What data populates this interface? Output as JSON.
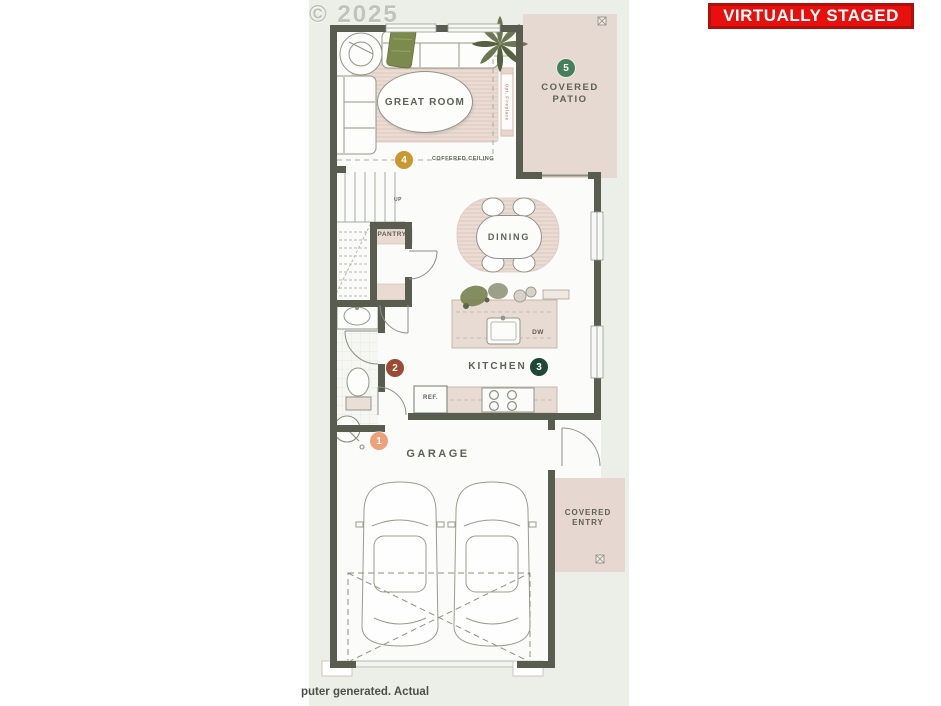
{
  "banner": {
    "label": "VIRTUALLY STAGED",
    "bg": "#e8100c",
    "border": "#b00f0b",
    "text": "#ffffff"
  },
  "watermark": "© 2025",
  "footer_fragment": "puter generated. Actual",
  "plan": {
    "colors": {
      "wall": "#585d50",
      "panel_bg": "#ecefe8",
      "floor": "#fbfcf9",
      "patio_beige": "#e6d9d1",
      "rug_beige": "#eadbd3",
      "label_text": "#5d6156"
    },
    "labels": {
      "great_room": "GREAT ROOM",
      "covered_patio": "COVERED PATIO",
      "dining": "DINING",
      "kitchen": "KITCHEN",
      "pantry": "PANTRY",
      "garage": "GARAGE",
      "covered_entry": "COVERED ENTRY",
      "ref": "REF.",
      "dw": "DW",
      "up": "UP",
      "coffered_ceiling": "COFFERED CEILING",
      "opt_fireplace": "Opt. Fireplace"
    },
    "markers": [
      {
        "num": "1",
        "room": "garage",
        "color": "#f0a078"
      },
      {
        "num": "2",
        "room": "powder-room",
        "color": "#9d4a33"
      },
      {
        "num": "3",
        "room": "kitchen",
        "color": "#1f4736"
      },
      {
        "num": "4",
        "room": "great-room",
        "color": "#c9992f"
      },
      {
        "num": "5",
        "room": "covered-patio",
        "color": "#45805a"
      }
    ],
    "icons": {
      "patio_corner": "utility-box",
      "entry_corner": "utility-box"
    }
  }
}
